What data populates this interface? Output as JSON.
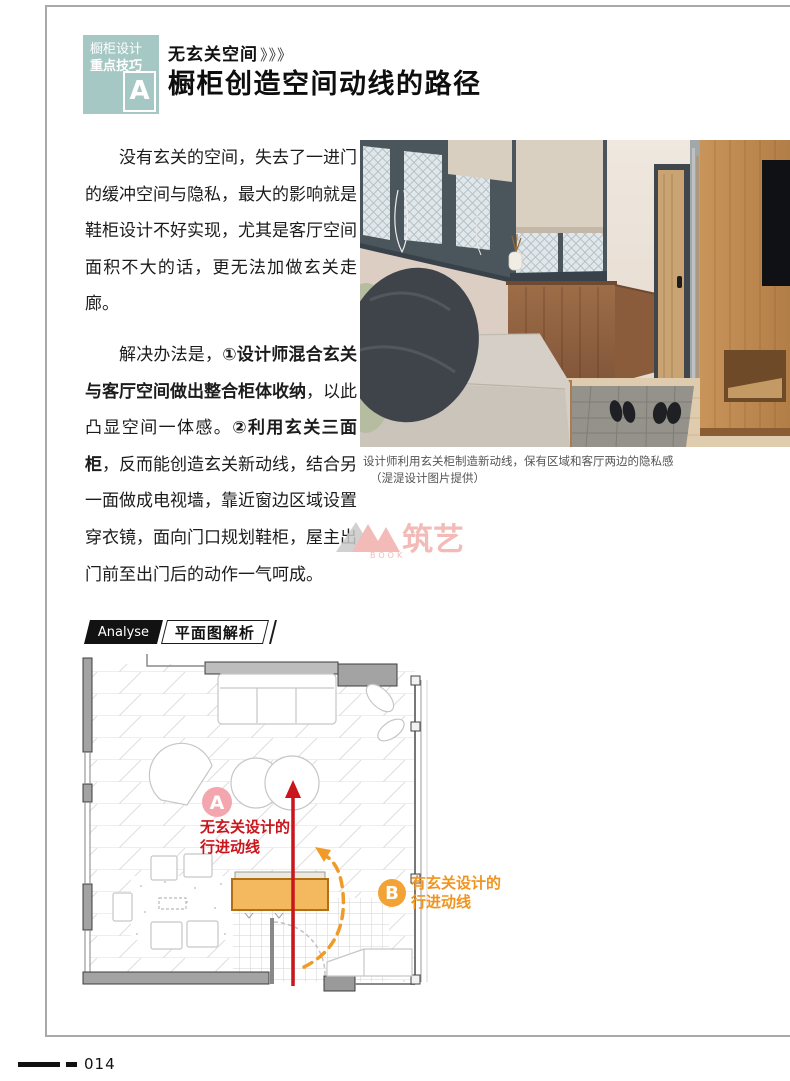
{
  "tag_box": {
    "line1": "橱柜设计",
    "line2": "重点技巧",
    "letter": "A"
  },
  "header": {
    "kicker": "无玄关空间",
    "kicker_arrows": "》》》",
    "title": "橱柜创造空间动线的路径"
  },
  "body": {
    "p1": "没有玄关的空间，失去了一进门的缓冲空间与隐私，最大的影响就是鞋柜设计不好实现，尤其是客厅空间面积不大的话，更无法加做玄关走廊。",
    "p2_runs": [
      {
        "text": "解决办法是，",
        "bold": false
      },
      {
        "text": "①设计师混合玄关与客厅空间做出整合柜体收纳",
        "bold": true
      },
      {
        "text": "，以此凸显空间一体感。",
        "bold": false
      },
      {
        "text": "②利用玄关三面柜",
        "bold": true
      },
      {
        "text": "，反而能创造玄关新动线，结合另一面做成电视墙，靠近窗边区域设置穿衣镜，面向门口规划鞋柜，屋主出门前至出门后的动作一气呵成。",
        "bold": false
      }
    ]
  },
  "photo": {
    "caption_line1": "设计师利用玄关柜制造新动线，保有区域和客厅两边的隐私感",
    "caption_line2": "（湜湜设计图片提供）"
  },
  "watermark": {
    "brand": "筑艺",
    "book": "BOOK"
  },
  "analyse": {
    "en": "Analyse",
    "zh": "平面图解析"
  },
  "plan": {
    "badge_a": "A",
    "label_a_line1": "无玄关设计的",
    "label_a_line2": "行进动线",
    "badge_b": "B",
    "label_b_line1": "有玄关设计的",
    "label_b_line2": "行进动线"
  },
  "footer": {
    "page_number": "014"
  },
  "colors": {
    "teal": "#a5c8c4",
    "red": "#c9151b",
    "orange": "#f09a28",
    "badge_a_pink": "#f3a6ad",
    "cabinet_orange": "#f4b85f"
  }
}
